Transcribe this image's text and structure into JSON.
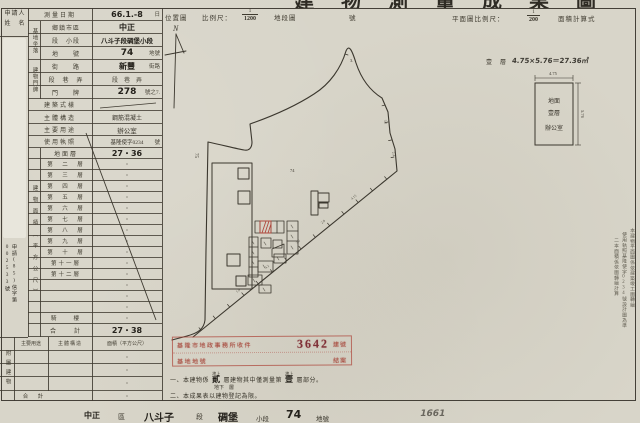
{
  "colors": {
    "paper": "#d8d5c9",
    "ink": "#3a362c",
    "stamp_red": "#a84a3e",
    "stamp_number_red": "#7e3038",
    "line": "#3e3a30"
  },
  "title": {
    "clipped_text": "建物測量成果圖"
  },
  "header": {
    "location_map": "位置圖",
    "scale_label": "比例尺：",
    "scale_num": "1",
    "scale_den": "1200",
    "section_map": "地段圖",
    "sheet_no_suffix": "號",
    "plan_scale_label": "平面圖比例尺：",
    "plan_num": "1",
    "plan_den": "200",
    "area_calc": "面積計算式"
  },
  "applicant": {
    "label_line1": "申請人",
    "label_line2": "姓　名",
    "ref_vertical": "申請(85)信字第002533號"
  },
  "site": {
    "survey_date_label": "測量日期",
    "survey_date": "66.1.-8",
    "survey_date_unit": "日",
    "group_location": "基地坐落",
    "group_address": "建物門牌",
    "rows": [
      {
        "label": "鄉鎮市區",
        "value": "中正",
        "unit": ""
      },
      {
        "label": "段　小段",
        "value": "八斗子段碉堡小段",
        "unit": ""
      },
      {
        "label": "地　　號",
        "value": "74",
        "unit": "地號"
      },
      {
        "label": "街　　路",
        "value": "新豐",
        "unit": "街路"
      },
      {
        "label": "段　巷　弄",
        "value": "段　巷　弄",
        "unit": ""
      },
      {
        "label": "門　　牌",
        "value": "278",
        "unit": "號之7."
      },
      {
        "label": "建築式樣",
        "value": "",
        "unit": ""
      },
      {
        "label": "主體構造",
        "value": "鋼筋混凝土",
        "unit": ""
      },
      {
        "label": "主要用途",
        "value": "辦公室",
        "unit": ""
      },
      {
        "label": "使用執照",
        "value": "基隆使字0234",
        "unit": "號"
      }
    ]
  },
  "floors": {
    "section_label": "建物面積（平方公尺）",
    "rows": [
      {
        "label": "地面層",
        "value": "27・36"
      },
      {
        "label": "第　二　層",
        "value": "・"
      },
      {
        "label": "第　三　層",
        "value": "・"
      },
      {
        "label": "第　四　層",
        "value": "・"
      },
      {
        "label": "第　五　層",
        "value": "・"
      },
      {
        "label": "第　六　層",
        "value": "・"
      },
      {
        "label": "第　七　層",
        "value": "・"
      },
      {
        "label": "第　八　層",
        "value": "・"
      },
      {
        "label": "第　九　層",
        "value": "・"
      },
      {
        "label": "第　十　層",
        "value": "・"
      },
      {
        "label": "第十一層",
        "value": "・"
      },
      {
        "label": "第十二層",
        "value": "・"
      },
      {
        "label": "",
        "value": "・"
      },
      {
        "label": "",
        "value": "・"
      },
      {
        "label": "",
        "value": "・"
      },
      {
        "label": "騎　　樓",
        "value": "・"
      },
      {
        "label": "合　　計",
        "value": "27・38"
      }
    ]
  },
  "annex": {
    "section_label": "附屬建物",
    "headers": {
      "use": "主要用途",
      "structure": "主體構造",
      "area": "面積（平方公尺）"
    },
    "rows": [
      {
        "value": "・"
      },
      {
        "value": "・"
      },
      {
        "value": "・"
      }
    ],
    "total_label": "合　計",
    "total_value": "・"
  },
  "map": {
    "north": "N",
    "parcel_75": "75",
    "parcel_74": "74",
    "parcel_3": "3.",
    "dim_marks": [
      "4.15",
      "2.8",
      "3.6",
      "4.2",
      "1.9",
      "3.1",
      "2.4"
    ]
  },
  "plan": {
    "floor_label": "壹　層",
    "calc": "4.75×5.76＝27.36㎡",
    "dim_top": "4.75",
    "dim_right": "5.76",
    "room": [
      "地面",
      "壹層",
      "辦公室"
    ]
  },
  "stamp": {
    "line1": "基隆市地政事務所收件",
    "number": "3642",
    "no_suffix": "建號",
    "line2": "基地地號",
    "line2_right": "結案"
  },
  "notes": {
    "sup": "地上",
    "sub": "地下　層",
    "n1a": "一、本建物係",
    "n1_fill1": "貳",
    "n1b": "層建物其中僅測量第",
    "n1_fill2": "壹",
    "n1c": "層部分。",
    "n2": "二、本成果表以建物登記為限。"
  },
  "margin_notes": [
    "本建物平面圖係依建築竣工圖轉繪",
    "使用執照基隆使字0234號設計圖為準",
    "二本面積係依圖轉繪計算"
  ],
  "footer": {
    "f1": "中正",
    "f2": "區",
    "f3": "八斗子",
    "f4": "段",
    "f5": "碉堡",
    "f6": "小段",
    "f7": "74",
    "f8": "地號",
    "hand": "1661"
  }
}
